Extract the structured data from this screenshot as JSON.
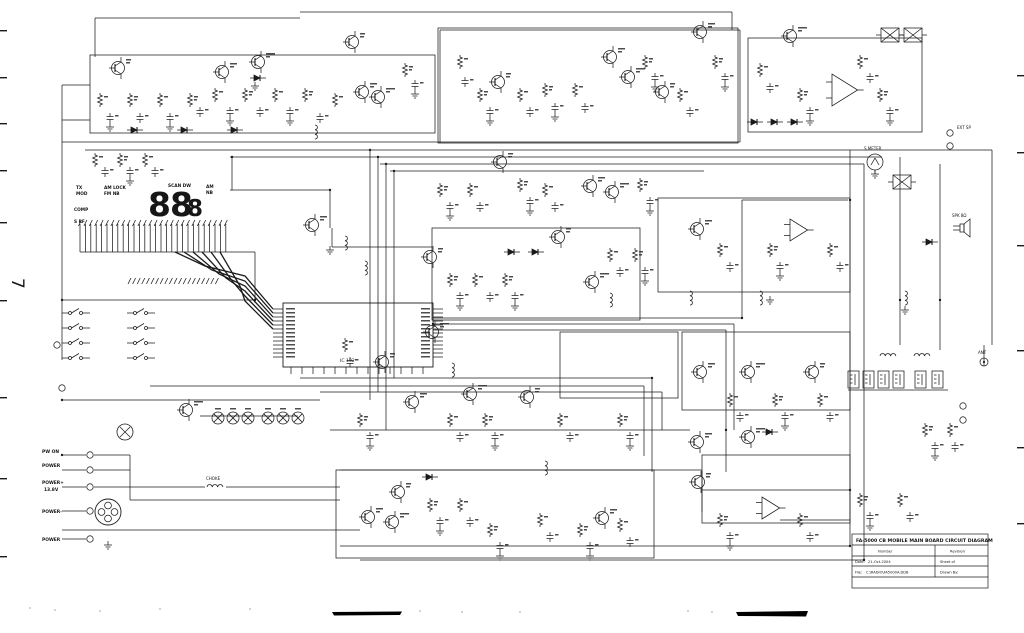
{
  "page": {
    "number": "7"
  },
  "display": {
    "digits_large": "88",
    "digit_small": "8",
    "ind_tx": "TX",
    "ind_mod": "MOD",
    "ind_am_lock": "AM LOCK",
    "ind_fm_nb": "FM NB",
    "ind_comp": "COMP",
    "ind_s_rf": "S RF",
    "ind_scan_dw": "SCAN DW",
    "ind_am": "AM",
    "ind_nb": "NB"
  },
  "mcu": {
    "label": "IC 102"
  },
  "connectors": {
    "pw_on": "PW ON",
    "power1": "POWER",
    "power_plus": "POWER+",
    "voltage": "13.8V",
    "power_minus": "POWER-",
    "power2": "POWER",
    "choke": "CHOKE"
  },
  "right_side": {
    "s_meter": "S METER",
    "ext_sp": "EXT SP",
    "spk": "SPK 8Ω",
    "ant": "ANT"
  },
  "title_block": {
    "title": "FA-5000 CB MOBILE MAIN BOARD CIRCUIT DIAGRAM",
    "number_label": "Number",
    "revision_label": "Revision",
    "date_label": "Date:",
    "date": "21-Oct-2004",
    "sheet_label": "Sheet  of",
    "file_label": "File:",
    "file": "C:\\RADIO\\FA5000A.DDB",
    "drawn_label": "Drawn By:"
  },
  "schematic": {
    "ink": "#1b1b1b",
    "boxes": [
      [
        90,
        55,
        345,
        78
      ],
      [
        438,
        28,
        300,
        115
      ],
      [
        748,
        38,
        174,
        94
      ],
      [
        432,
        228,
        208,
        92
      ],
      [
        658,
        198,
        192,
        94
      ],
      [
        560,
        332,
        118,
        66
      ],
      [
        682,
        332,
        168,
        78
      ],
      [
        336,
        470,
        318,
        88
      ],
      [
        702,
        455,
        148,
        68
      ]
    ],
    "mcu_box": [
      283,
      303,
      150,
      64
    ],
    "wires": [
      [
        95,
        18,
        300,
        18
      ],
      [
        300,
        12,
        732,
        12
      ],
      [
        732,
        12,
        732,
        30
      ],
      [
        95,
        18,
        95,
        57
      ],
      [
        62,
        85,
        90,
        85
      ],
      [
        62,
        120,
        90,
        120
      ],
      [
        62,
        85,
        62,
        360
      ],
      [
        62,
        142,
        740,
        142
      ],
      [
        85,
        150,
        992,
        150
      ],
      [
        230,
        157,
        882,
        157
      ],
      [
        380,
        164,
        864,
        164
      ],
      [
        390,
        171,
        704,
        171
      ],
      [
        992,
        150,
        992,
        345
      ],
      [
        850,
        150,
        850,
        546
      ],
      [
        864,
        164,
        864,
        560
      ],
      [
        440,
        30,
        440,
        143
      ],
      [
        740,
        30,
        740,
        142
      ],
      [
        440,
        30,
        740,
        30
      ],
      [
        370,
        150,
        370,
        400
      ],
      [
        378,
        157,
        378,
        392
      ],
      [
        386,
        164,
        386,
        430
      ],
      [
        394,
        171,
        394,
        378
      ],
      [
        230,
        190,
        330,
        190
      ],
      [
        330,
        190,
        330,
        228
      ],
      [
        232,
        157,
        232,
        190
      ],
      [
        332,
        228,
        332,
        247
      ],
      [
        332,
        247,
        432,
        247
      ],
      [
        80,
        252,
        255,
        252
      ],
      [
        255,
        252,
        255,
        303
      ],
      [
        62,
        300,
        255,
        300
      ],
      [
        433,
        318,
        742,
        318
      ],
      [
        433,
        324,
        734,
        324
      ],
      [
        433,
        330,
        726,
        330
      ],
      [
        742,
        318,
        742,
        200
      ],
      [
        734,
        324,
        734,
        430
      ],
      [
        726,
        330,
        726,
        472
      ],
      [
        742,
        200,
        848,
        200
      ],
      [
        300,
        378,
        652,
        378
      ],
      [
        150,
        386,
        644,
        386
      ],
      [
        320,
        392,
        662,
        392
      ],
      [
        62,
        400,
        320,
        400
      ],
      [
        652,
        378,
        652,
        472
      ],
      [
        644,
        386,
        644,
        456
      ],
      [
        662,
        392,
        662,
        430
      ],
      [
        330,
        430,
        690,
        430
      ],
      [
        62,
        455,
        86,
        455
      ],
      [
        62,
        470,
        86,
        470
      ],
      [
        62,
        487,
        86,
        487
      ],
      [
        62,
        511,
        86,
        511
      ],
      [
        62,
        539,
        86,
        539
      ],
      [
        94,
        487,
        205,
        487
      ],
      [
        226,
        487,
        340,
        487
      ],
      [
        340,
        470,
        702,
        470
      ],
      [
        130,
        500,
        340,
        500
      ],
      [
        62,
        530,
        360,
        530
      ],
      [
        340,
        546,
        850,
        546
      ],
      [
        360,
        560,
        864,
        560
      ],
      [
        702,
        470,
        702,
        512
      ],
      [
        702,
        490,
        850,
        490
      ],
      [
        780,
        520,
        850,
        520
      ],
      [
        94,
        455,
        130,
        455
      ],
      [
        94,
        470,
        130,
        470
      ],
      [
        130,
        455,
        130,
        500
      ],
      [
        200,
        416,
        298,
        416
      ],
      [
        900,
        157,
        900,
        345
      ],
      [
        940,
        164,
        940,
        350
      ],
      [
        848,
        390,
        948,
        390
      ],
      [
        984,
        366,
        984,
        345
      ]
    ],
    "junctions": [
      [
        370,
        150
      ],
      [
        378,
        157
      ],
      [
        386,
        164
      ],
      [
        394,
        171
      ],
      [
        850,
        200
      ],
      [
        742,
        318
      ],
      [
        652,
        378
      ],
      [
        330,
        190
      ],
      [
        255,
        300
      ],
      [
        62,
        400
      ],
      [
        864,
        560
      ],
      [
        850,
        546
      ],
      [
        900,
        300
      ],
      [
        940,
        300
      ],
      [
        726,
        430
      ],
      [
        433,
        324
      ],
      [
        232,
        157
      ],
      [
        62,
        455
      ],
      [
        850,
        490
      ],
      [
        62,
        300
      ]
    ],
    "transistors": [
      [
        118,
        68
      ],
      [
        222,
        72
      ],
      [
        258,
        62
      ],
      [
        352,
        42
      ],
      [
        362,
        92
      ],
      [
        378,
        97
      ],
      [
        498,
        82
      ],
      [
        610,
        57
      ],
      [
        628,
        77
      ],
      [
        662,
        92
      ],
      [
        700,
        32
      ],
      [
        790,
        36
      ],
      [
        500,
        162
      ],
      [
        590,
        186
      ],
      [
        612,
        192
      ],
      [
        558,
        237
      ],
      [
        697,
        229
      ],
      [
        592,
        282
      ],
      [
        430,
        257
      ],
      [
        312,
        225
      ],
      [
        432,
        332
      ],
      [
        382,
        362
      ],
      [
        412,
        402
      ],
      [
        470,
        394
      ],
      [
        527,
        397
      ],
      [
        700,
        372
      ],
      [
        748,
        372
      ],
      [
        812,
        372
      ],
      [
        697,
        442
      ],
      [
        748,
        437
      ],
      [
        398,
        492
      ],
      [
        368,
        517
      ],
      [
        392,
        522
      ],
      [
        698,
        482
      ],
      [
        602,
        518
      ],
      [
        186,
        410
      ]
    ],
    "resistors": [
      [
        100,
        100
      ],
      [
        130,
        100
      ],
      [
        160,
        100
      ],
      [
        190,
        100
      ],
      [
        215,
        95
      ],
      [
        245,
        95
      ],
      [
        275,
        95
      ],
      [
        305,
        95
      ],
      [
        335,
        100
      ],
      [
        405,
        70
      ],
      [
        460,
        62
      ],
      [
        480,
        95
      ],
      [
        520,
        95
      ],
      [
        545,
        90
      ],
      [
        575,
        90
      ],
      [
        645,
        62
      ],
      [
        680,
        95
      ],
      [
        715,
        62
      ],
      [
        760,
        70
      ],
      [
        800,
        95
      ],
      [
        860,
        62
      ],
      [
        880,
        95
      ],
      [
        95,
        160
      ],
      [
        120,
        160
      ],
      [
        145,
        160
      ],
      [
        440,
        190
      ],
      [
        470,
        190
      ],
      [
        520,
        185
      ],
      [
        545,
        190
      ],
      [
        640,
        185
      ],
      [
        720,
        250
      ],
      [
        770,
        250
      ],
      [
        830,
        250
      ],
      [
        450,
        280
      ],
      [
        475,
        280
      ],
      [
        505,
        280
      ],
      [
        610,
        255
      ],
      [
        635,
        255
      ],
      [
        345,
        345
      ],
      [
        360,
        420
      ],
      [
        450,
        420
      ],
      [
        485,
        420
      ],
      [
        560,
        420
      ],
      [
        620,
        420
      ],
      [
        730,
        400
      ],
      [
        775,
        400
      ],
      [
        820,
        400
      ],
      [
        430,
        505
      ],
      [
        460,
        505
      ],
      [
        490,
        530
      ],
      [
        540,
        520
      ],
      [
        580,
        530
      ],
      [
        620,
        525
      ],
      [
        720,
        520
      ],
      [
        800,
        520
      ],
      [
        860,
        500
      ],
      [
        900,
        500
      ],
      [
        925,
        430
      ],
      [
        950,
        430
      ]
    ],
    "caps": [
      [
        110,
        118
      ],
      [
        140,
        118
      ],
      [
        170,
        118
      ],
      [
        200,
        112
      ],
      [
        230,
        112
      ],
      [
        260,
        112
      ],
      [
        290,
        112
      ],
      [
        320,
        118
      ],
      [
        415,
        85
      ],
      [
        465,
        82
      ],
      [
        490,
        112
      ],
      [
        530,
        112
      ],
      [
        555,
        108
      ],
      [
        585,
        108
      ],
      [
        655,
        78
      ],
      [
        690,
        112
      ],
      [
        725,
        78
      ],
      [
        770,
        88
      ],
      [
        810,
        112
      ],
      [
        870,
        78
      ],
      [
        890,
        112
      ],
      [
        105,
        172
      ],
      [
        130,
        172
      ],
      [
        155,
        172
      ],
      [
        450,
        207
      ],
      [
        480,
        207
      ],
      [
        530,
        202
      ],
      [
        555,
        207
      ],
      [
        650,
        202
      ],
      [
        730,
        267
      ],
      [
        780,
        267
      ],
      [
        840,
        267
      ],
      [
        460,
        297
      ],
      [
        490,
        297
      ],
      [
        515,
        297
      ],
      [
        620,
        272
      ],
      [
        645,
        272
      ],
      [
        350,
        362
      ],
      [
        370,
        437
      ],
      [
        460,
        437
      ],
      [
        495,
        437
      ],
      [
        570,
        437
      ],
      [
        630,
        437
      ],
      [
        740,
        417
      ],
      [
        785,
        417
      ],
      [
        830,
        417
      ],
      [
        440,
        522
      ],
      [
        470,
        522
      ],
      [
        500,
        547
      ],
      [
        550,
        537
      ],
      [
        590,
        547
      ],
      [
        630,
        542
      ],
      [
        730,
        537
      ],
      [
        810,
        537
      ],
      [
        870,
        517
      ],
      [
        910,
        517
      ],
      [
        935,
        447
      ],
      [
        955,
        447
      ]
    ],
    "grounds_extra": [
      [
        255,
        86
      ],
      [
        330,
        250
      ],
      [
        770,
        300
      ],
      [
        905,
        310
      ],
      [
        875,
        174
      ],
      [
        108,
        545
      ]
    ],
    "coils": [
      [
        315,
        132
      ],
      [
        345,
        243
      ],
      [
        365,
        268
      ],
      [
        610,
        300
      ],
      [
        452,
        370
      ],
      [
        545,
        468
      ],
      [
        760,
        298
      ],
      [
        690,
        298
      ],
      [
        905,
        298
      ]
    ],
    "hcoils": [
      [
        215,
        487
      ],
      [
        888,
        356
      ],
      [
        922,
        356
      ]
    ],
    "diodes": [
      [
        135,
        130
      ],
      [
        185,
        130
      ],
      [
        235,
        130
      ],
      [
        512,
        252
      ],
      [
        536,
        252
      ],
      [
        755,
        122
      ],
      [
        775,
        122
      ],
      [
        795,
        122
      ],
      [
        430,
        477
      ],
      [
        770,
        432
      ],
      [
        930,
        242
      ],
      [
        258,
        78
      ]
    ],
    "filters": [
      [
        890,
        35
      ],
      [
        913,
        35
      ],
      [
        902,
        182
      ]
    ],
    "opamps": [
      [
        832,
        90,
        16
      ],
      [
        790,
        230,
        11
      ],
      [
        762,
        508,
        11
      ]
    ],
    "cans": [
      [
        848,
        371
      ],
      [
        863,
        371
      ],
      [
        878,
        371
      ],
      [
        893,
        371
      ],
      [
        915,
        371
      ],
      [
        932,
        371
      ]
    ],
    "lamps": [
      [
        218,
        418
      ],
      [
        233,
        418
      ],
      [
        248,
        418
      ],
      [
        268,
        418
      ],
      [
        283,
        418
      ],
      [
        298,
        418
      ]
    ],
    "encoder": [
      125,
      432,
      8
    ],
    "switches": [
      [
        70,
        313
      ],
      [
        70,
        328
      ],
      [
        70,
        343
      ],
      [
        70,
        358
      ],
      [
        135,
        313
      ],
      [
        135,
        328
      ],
      [
        135,
        343
      ],
      [
        135,
        358
      ]
    ],
    "jacks": [
      [
        90,
        455
      ],
      [
        90,
        470
      ],
      [
        90,
        487
      ],
      [
        90,
        511
      ],
      [
        90,
        539
      ],
      [
        950,
        133
      ],
      [
        950,
        146
      ],
      [
        963,
        406
      ],
      [
        963,
        420
      ],
      [
        57,
        345
      ],
      [
        62,
        388
      ]
    ],
    "din_connector": [
      108,
      512,
      13
    ],
    "speaker": [
      963,
      228
    ],
    "meter": [
      875,
      162,
      8
    ],
    "ant_conn": [
      984,
      362,
      4
    ],
    "comb": {
      "x0": 80,
      "step": 5.4,
      "count": 28,
      "y_top": 224,
      "y_bot": 252
    },
    "hatch2": {
      "x0": 128,
      "step": 4.6,
      "count": 20,
      "y": 281
    },
    "bundle": {
      "count": 6
    },
    "mcu_pins": {
      "left_x": 283,
      "right_x": 433,
      "y0": 309,
      "dy": 4,
      "rows": 13,
      "bot_y": 367,
      "bx0": 291,
      "bdx": 11,
      "bcount": 13
    },
    "edge_marks_left_y": [
      30,
      77,
      123,
      170,
      222,
      300,
      397,
      478,
      556
    ],
    "edge_marks_right_y": [
      75,
      152,
      245,
      350,
      447,
      523
    ],
    "streaks": [
      [
        332,
        612,
        402,
        611.5,
        400,
        615,
        334,
        615.5
      ],
      [
        736,
        612,
        808,
        611,
        806,
        616.5,
        738,
        616
      ]
    ],
    "specks": [
      [
        55,
        610
      ],
      [
        100,
        611
      ],
      [
        160,
        609
      ],
      [
        420,
        611
      ],
      [
        462,
        612
      ],
      [
        688,
        611
      ],
      [
        712,
        612
      ],
      [
        250,
        609
      ],
      [
        30,
        608
      ],
      [
        520,
        612
      ]
    ]
  }
}
